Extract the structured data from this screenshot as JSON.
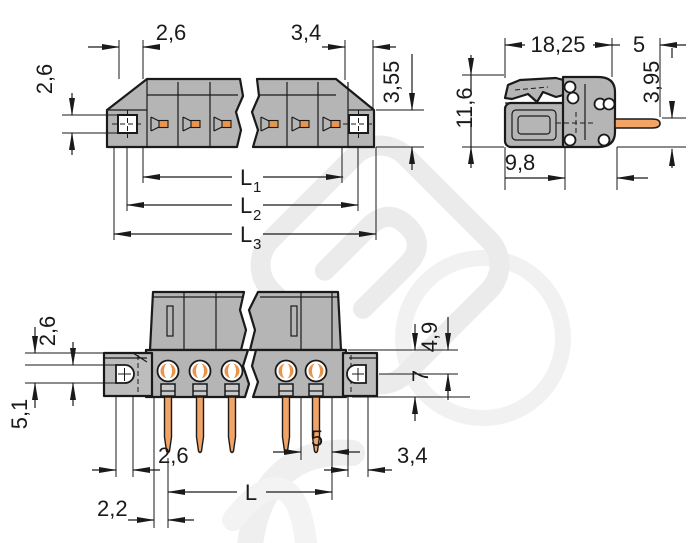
{
  "drawing": {
    "kind": "connector-dimensional-drawing",
    "decimal_style": "comma",
    "views": [
      "top-view",
      "side-view",
      "front-view"
    ]
  },
  "colors": {
    "background": "#ffffff",
    "line": "#1a1a1a",
    "body_gray": "#b5b5b5",
    "flange_gray": "#bdbdbd",
    "pin_orange": "#f2a466",
    "contact_orange": "#e8954e",
    "watermark": "#ebebeb"
  },
  "views": {
    "top": {
      "labels": {
        "pitch": "2,6",
        "end": "3,4",
        "hole": "2,6",
        "depth": "3,55",
        "l1": "L",
        "l1s": "1",
        "l2": "L",
        "l2s": "2",
        "l3": "L",
        "l3s": "3"
      }
    },
    "side": {
      "labels": {
        "width": "18,25",
        "pin": "5",
        "height": "11,6",
        "offset": "3,95",
        "depth": "9,8"
      }
    },
    "front": {
      "labels": {
        "hole": "2,6",
        "drop": "5,1",
        "top": "4,9",
        "flange": "7",
        "holew": "2,6",
        "pitch": "5",
        "slot": "3,4",
        "length": "L",
        "inset": "2,2"
      }
    }
  }
}
